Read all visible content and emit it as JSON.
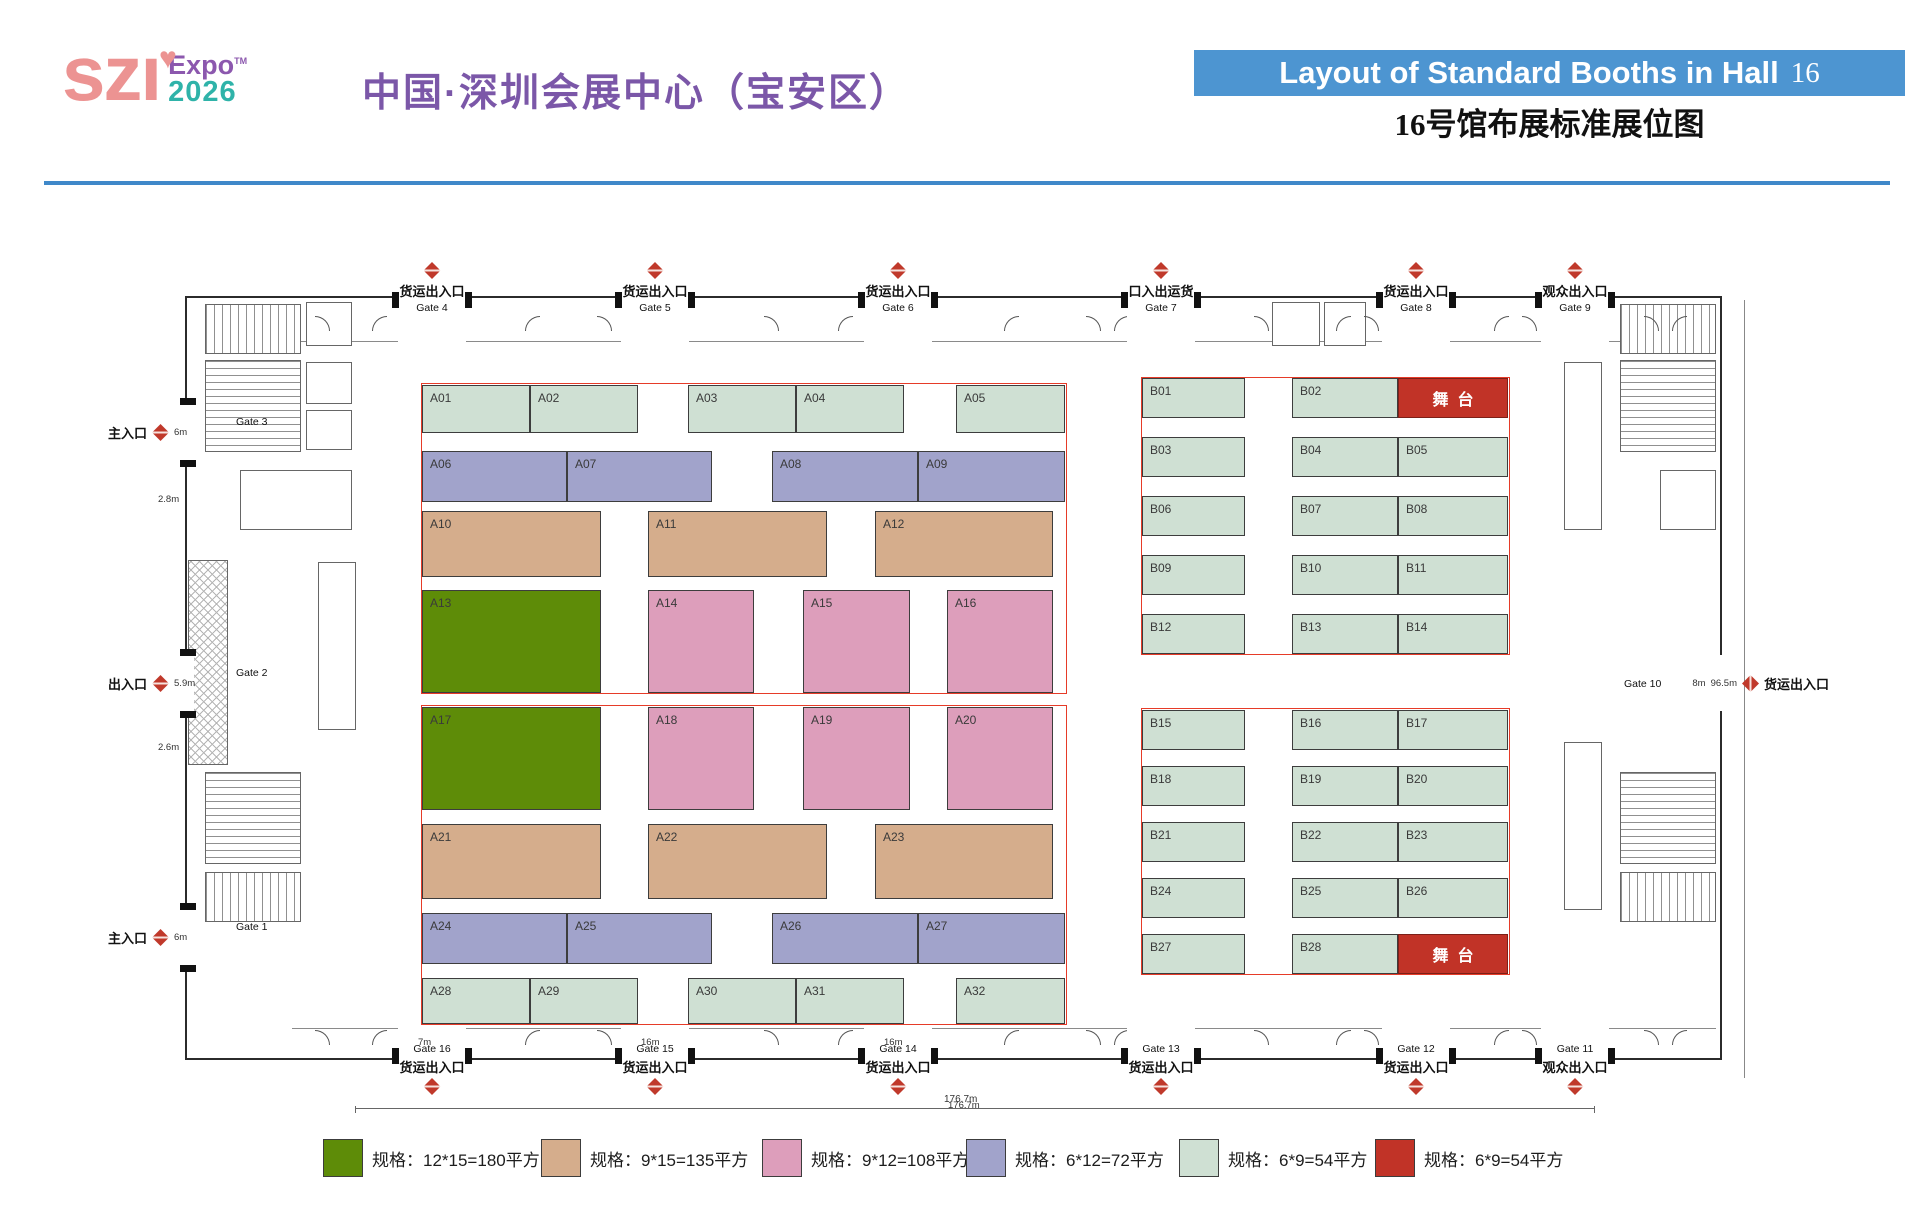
{
  "header": {
    "logo_main": "szı",
    "logo_heart": "♥",
    "logo_expo": "Expo",
    "logo_tm": "TM",
    "logo_year": "2026",
    "title_cn": "中国·深圳会展中心（宝安区）",
    "banner_text": "Layout of Standard Booths in Hall",
    "banner_hall_no": "16",
    "subtitle_cn": "16号馆布展标准展位图"
  },
  "colors": {
    "banner_blue": "#4d95d1",
    "divider_blue": "#3f88c9",
    "title_purple": "#7b57a8",
    "logo_pink": "#ec9392",
    "logo_purple": "#8c58ae",
    "logo_teal": "#2fb3a9",
    "marker_red": "#c0392b",
    "booth_types": {
      "g": "#5e8c08",
      "t": "#d5ad8c",
      "p": "#dd9ebb",
      "v": "#a1a3cb",
      "s": "#cfe0d3",
      "r": "#c13327"
    }
  },
  "plan": {
    "stage_label": "舞台",
    "booths": [
      {
        "label": "A01",
        "type": "s",
        "x": 422,
        "y": 385,
        "w": 108,
        "h": 48
      },
      {
        "label": "A02",
        "type": "s",
        "x": 530,
        "y": 385,
        "w": 108,
        "h": 48
      },
      {
        "label": "A03",
        "type": "s",
        "x": 688,
        "y": 385,
        "w": 108,
        "h": 48
      },
      {
        "label": "A04",
        "type": "s",
        "x": 796,
        "y": 385,
        "w": 108,
        "h": 48
      },
      {
        "label": "A05",
        "type": "s",
        "x": 956,
        "y": 385,
        "w": 109,
        "h": 48
      },
      {
        "label": "A06",
        "type": "v",
        "x": 422,
        "y": 451,
        "w": 145,
        "h": 51
      },
      {
        "label": "A07",
        "type": "v",
        "x": 567,
        "y": 451,
        "w": 145,
        "h": 51
      },
      {
        "label": "A08",
        "type": "v",
        "x": 772,
        "y": 451,
        "w": 146,
        "h": 51
      },
      {
        "label": "A09",
        "type": "v",
        "x": 918,
        "y": 451,
        "w": 147,
        "h": 51
      },
      {
        "label": "A10",
        "type": "t",
        "x": 422,
        "y": 511,
        "w": 179,
        "h": 66
      },
      {
        "label": "A11",
        "type": "t",
        "x": 648,
        "y": 511,
        "w": 179,
        "h": 66
      },
      {
        "label": "A12",
        "type": "t",
        "x": 875,
        "y": 511,
        "w": 178,
        "h": 66
      },
      {
        "label": "A13",
        "type": "g",
        "x": 422,
        "y": 590,
        "w": 179,
        "h": 103
      },
      {
        "label": "A14",
        "type": "p",
        "x": 648,
        "y": 590,
        "w": 106,
        "h": 103
      },
      {
        "label": "A15",
        "type": "p",
        "x": 803,
        "y": 590,
        "w": 107,
        "h": 103
      },
      {
        "label": "A16",
        "type": "p",
        "x": 947,
        "y": 590,
        "w": 106,
        "h": 103
      },
      {
        "label": "A17",
        "type": "g",
        "x": 422,
        "y": 707,
        "w": 179,
        "h": 103
      },
      {
        "label": "A18",
        "type": "p",
        "x": 648,
        "y": 707,
        "w": 106,
        "h": 103
      },
      {
        "label": "A19",
        "type": "p",
        "x": 803,
        "y": 707,
        "w": 107,
        "h": 103
      },
      {
        "label": "A20",
        "type": "p",
        "x": 947,
        "y": 707,
        "w": 106,
        "h": 103
      },
      {
        "label": "A21",
        "type": "t",
        "x": 422,
        "y": 824,
        "w": 179,
        "h": 75
      },
      {
        "label": "A22",
        "type": "t",
        "x": 648,
        "y": 824,
        "w": 179,
        "h": 75
      },
      {
        "label": "A23",
        "type": "t",
        "x": 875,
        "y": 824,
        "w": 178,
        "h": 75
      },
      {
        "label": "A24",
        "type": "v",
        "x": 422,
        "y": 913,
        "w": 145,
        "h": 51
      },
      {
        "label": "A25",
        "type": "v",
        "x": 567,
        "y": 913,
        "w": 145,
        "h": 51
      },
      {
        "label": "A26",
        "type": "v",
        "x": 772,
        "y": 913,
        "w": 146,
        "h": 51
      },
      {
        "label": "A27",
        "type": "v",
        "x": 918,
        "y": 913,
        "w": 147,
        "h": 51
      },
      {
        "label": "A28",
        "type": "s",
        "x": 422,
        "y": 978,
        "w": 108,
        "h": 46
      },
      {
        "label": "A29",
        "type": "s",
        "x": 530,
        "y": 978,
        "w": 108,
        "h": 46
      },
      {
        "label": "A30",
        "type": "s",
        "x": 688,
        "y": 978,
        "w": 108,
        "h": 46
      },
      {
        "label": "A31",
        "type": "s",
        "x": 796,
        "y": 978,
        "w": 108,
        "h": 46
      },
      {
        "label": "A32",
        "type": "s",
        "x": 956,
        "y": 978,
        "w": 109,
        "h": 46
      },
      {
        "label": "B01",
        "type": "s",
        "x": 1142,
        "y": 378,
        "w": 103,
        "h": 40
      },
      {
        "label": "B02",
        "type": "s",
        "x": 1292,
        "y": 378,
        "w": 106,
        "h": 40
      },
      {
        "label": "舞台",
        "type": "r",
        "x": 1398,
        "y": 378,
        "w": 110,
        "h": 40
      },
      {
        "label": "B03",
        "type": "s",
        "x": 1142,
        "y": 437,
        "w": 103,
        "h": 40
      },
      {
        "label": "B04",
        "type": "s",
        "x": 1292,
        "y": 437,
        "w": 106,
        "h": 40
      },
      {
        "label": "B05",
        "type": "s",
        "x": 1398,
        "y": 437,
        "w": 110,
        "h": 40
      },
      {
        "label": "B06",
        "type": "s",
        "x": 1142,
        "y": 496,
        "w": 103,
        "h": 40
      },
      {
        "label": "B07",
        "type": "s",
        "x": 1292,
        "y": 496,
        "w": 106,
        "h": 40
      },
      {
        "label": "B08",
        "type": "s",
        "x": 1398,
        "y": 496,
        "w": 110,
        "h": 40
      },
      {
        "label": "B09",
        "type": "s",
        "x": 1142,
        "y": 555,
        "w": 103,
        "h": 40
      },
      {
        "label": "B10",
        "type": "s",
        "x": 1292,
        "y": 555,
        "w": 106,
        "h": 40
      },
      {
        "label": "B11",
        "type": "s",
        "x": 1398,
        "y": 555,
        "w": 110,
        "h": 40
      },
      {
        "label": "B12",
        "type": "s",
        "x": 1142,
        "y": 614,
        "w": 103,
        "h": 40
      },
      {
        "label": "B13",
        "type": "s",
        "x": 1292,
        "y": 614,
        "w": 106,
        "h": 40
      },
      {
        "label": "B14",
        "type": "s",
        "x": 1398,
        "y": 614,
        "w": 110,
        "h": 40
      },
      {
        "label": "B15",
        "type": "s",
        "x": 1142,
        "y": 710,
        "w": 103,
        "h": 40
      },
      {
        "label": "B16",
        "type": "s",
        "x": 1292,
        "y": 710,
        "w": 106,
        "h": 40
      },
      {
        "label": "B17",
        "type": "s",
        "x": 1398,
        "y": 710,
        "w": 110,
        "h": 40
      },
      {
        "label": "B18",
        "type": "s",
        "x": 1142,
        "y": 766,
        "w": 103,
        "h": 40
      },
      {
        "label": "B19",
        "type": "s",
        "x": 1292,
        "y": 766,
        "w": 106,
        "h": 40
      },
      {
        "label": "B20",
        "type": "s",
        "x": 1398,
        "y": 766,
        "w": 110,
        "h": 40
      },
      {
        "label": "B21",
        "type": "s",
        "x": 1142,
        "y": 822,
        "w": 103,
        "h": 40
      },
      {
        "label": "B22",
        "type": "s",
        "x": 1292,
        "y": 822,
        "w": 106,
        "h": 40
      },
      {
        "label": "B23",
        "type": "s",
        "x": 1398,
        "y": 822,
        "w": 110,
        "h": 40
      },
      {
        "label": "B24",
        "type": "s",
        "x": 1142,
        "y": 878,
        "w": 103,
        "h": 40
      },
      {
        "label": "B25",
        "type": "s",
        "x": 1292,
        "y": 878,
        "w": 106,
        "h": 40
      },
      {
        "label": "B26",
        "type": "s",
        "x": 1398,
        "y": 878,
        "w": 110,
        "h": 40
      },
      {
        "label": "B27",
        "type": "s",
        "x": 1142,
        "y": 934,
        "w": 103,
        "h": 40
      },
      {
        "label": "B28",
        "type": "s",
        "x": 1292,
        "y": 934,
        "w": 106,
        "h": 40
      },
      {
        "label": "舞台",
        "type": "r",
        "x": 1398,
        "y": 934,
        "w": 110,
        "h": 40
      }
    ],
    "sections": [
      {
        "x": 421,
        "y": 383,
        "w": 646,
        "h": 311
      },
      {
        "x": 421,
        "y": 705,
        "w": 646,
        "h": 320
      },
      {
        "x": 1141,
        "y": 377,
        "w": 369,
        "h": 278
      },
      {
        "x": 1141,
        "y": 708,
        "w": 369,
        "h": 267
      }
    ],
    "markers": {
      "top": [
        {
          "x": 432,
          "cn": "货运出入口",
          "gate": "Gate 4"
        },
        {
          "x": 655,
          "cn": "货运出入口",
          "gate": "Gate 5"
        },
        {
          "x": 898,
          "cn": "货运出入口",
          "gate": "Gate 6"
        },
        {
          "x": 1161,
          "cn": "口入出运货",
          "gate": "Gate 7"
        },
        {
          "x": 1416,
          "cn": "货运出入口",
          "gate": "Gate 8"
        },
        {
          "x": 1575,
          "cn": "观众出入口",
          "gate": "Gate 9"
        }
      ],
      "bottom": [
        {
          "x": 432,
          "cn": "货运出入口",
          "gate": "Gate 16"
        },
        {
          "x": 655,
          "cn": "货运出入口",
          "gate": "Gate 15"
        },
        {
          "x": 898,
          "cn": "货运出入口",
          "gate": "Gate 14"
        },
        {
          "x": 1161,
          "cn": "货运出入口",
          "gate": "Gate 13"
        },
        {
          "x": 1416,
          "cn": "货运出入口",
          "gate": "Gate 12"
        },
        {
          "x": 1575,
          "cn": "观众出入口",
          "gate": "Gate 11"
        }
      ],
      "left": [
        {
          "y": 432,
          "cn": "主入口",
          "gate": "Gate 3",
          "dim": "6m"
        },
        {
          "y": 683,
          "cn": "出入口",
          "gate": "Gate 2",
          "dim": "5.9m"
        },
        {
          "y": 937,
          "cn": "主入口",
          "gate": "Gate 1",
          "dim": "6m"
        }
      ],
      "right": {
        "y": 683,
        "gate": "Gate 10",
        "dim1": "8m",
        "dim2": "96.5m",
        "cn": "货运出入口"
      }
    },
    "dims": [
      {
        "text": "7m",
        "x": 432,
        "y": 1037
      },
      {
        "text": "16m",
        "x": 655,
        "y": 1037
      },
      {
        "text": "16m",
        "x": 898,
        "y": 1037
      },
      {
        "text": "2.8m",
        "x": 172,
        "y": 494
      },
      {
        "text": "2.6m",
        "x": 172,
        "y": 742
      },
      {
        "text": "176.7m",
        "x": 962,
        "y": 1100
      }
    ]
  },
  "legend": [
    {
      "type": "g",
      "label": "规格：12*15=180平方"
    },
    {
      "type": "t",
      "label": "规格：9*15=135平方"
    },
    {
      "type": "p",
      "label": "规格：9*12=108平方"
    },
    {
      "type": "v",
      "label": "规格：6*12=72平方"
    },
    {
      "type": "s",
      "label": "规格：6*9=54平方"
    },
    {
      "type": "r",
      "label": "规格：6*9=54平方"
    }
  ]
}
